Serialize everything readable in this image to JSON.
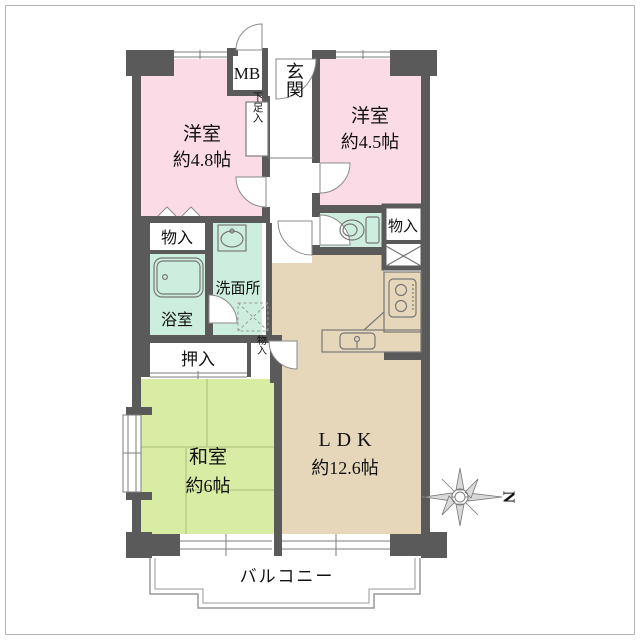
{
  "plan_title": "apartment-floor-plan",
  "rooms": {
    "western1": {
      "label": "洋室",
      "size": "約4.8帖"
    },
    "western2": {
      "label": "洋室",
      "size": "約4.5帖"
    },
    "japanese": {
      "label": "和室",
      "size": "約6帖"
    },
    "ldk": {
      "label": "LDK",
      "size": "約12.6帖"
    },
    "entrance": {
      "label": "玄関"
    },
    "washroom": {
      "label": "洗面所"
    },
    "bathroom": {
      "label": "浴室"
    },
    "balcony": {
      "label": "バルコニー"
    }
  },
  "storage": {
    "meter_box": "MB",
    "shoe_cabinet": "下足入",
    "closet_west1": "物入",
    "closet_hall": "物入",
    "closet_small": "物入",
    "futon_closet": "押入"
  },
  "compass": {
    "north_label": "N"
  },
  "colors": {
    "wall": "#5a5a5a",
    "western_room": "#fbdce6",
    "wet_area": "#cdeede",
    "japanese_room": "#d9eca3",
    "ldk": "#e6d7bb",
    "tatami_line": "#b7cd87",
    "balcony_line": "#9a9a9a"
  },
  "icons": {
    "bathtub": "bathtub-icon",
    "washbasin": "washbasin-icon",
    "toilet": "toilet-icon",
    "stove": "stove-icon",
    "kitchen_sink": "kitchen-sink-icon",
    "washing_machine_space": "washing-machine-space-icon",
    "pipe_space": "pipe-space-icon",
    "compass_rose": "compass-rose-icon"
  }
}
